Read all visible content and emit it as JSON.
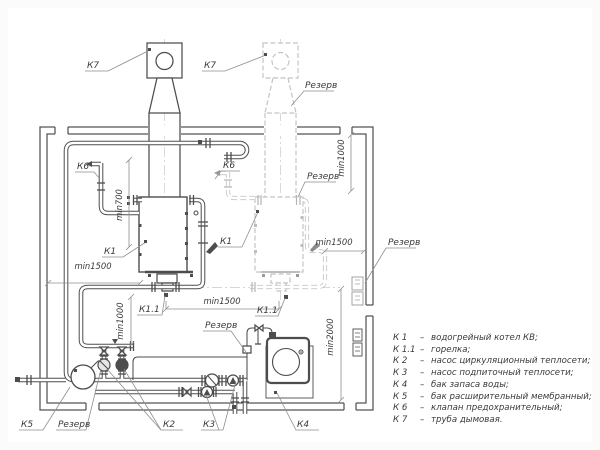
{
  "colors": {
    "line": "#4d4d4d",
    "reserve_line": "#c6c6c6",
    "background": "#ffffff",
    "text": "#3a3a3a"
  },
  "labels": {
    "k7_left": "К7",
    "k7_right": "К7",
    "k6_left": "К6",
    "k6_right": "К6",
    "k1_left": "К1",
    "k1_right": "К1",
    "k11_left": "К1.1",
    "k11_right": "К1.1",
    "k5": "К5",
    "k2": "К2",
    "k3": "К3",
    "k4": "К4",
    "reserve_chimney": "Резерв",
    "reserve_top": "Резерв",
    "reserve_wall": "Резерв",
    "reserve_makeup": "Резерв",
    "reserve_pump": "Резерв"
  },
  "dims": {
    "min700": "min700",
    "min1000_top": "min1000",
    "min1000_bottom": "min1000",
    "min1500_left": "min1500",
    "min1500_center": "min1500",
    "min1500_right": "min1500",
    "min2000": "min2000"
  },
  "legend": {
    "sep": "–",
    "items": [
      {
        "key": "К 1",
        "desc": "водогрейный котел КВ;"
      },
      {
        "key": "К 1.1",
        "desc": "горелка;"
      },
      {
        "key": "К 2",
        "desc": "насос циркуляционный теплосети;"
      },
      {
        "key": "К 3",
        "desc": "насос подпиточный теплосети;"
      },
      {
        "key": "К 4",
        "desc": "бак запаса воды;"
      },
      {
        "key": "К 5",
        "desc": "бак расширительный мембранный;"
      },
      {
        "key": "К 6",
        "desc": "клапан предохранительный;"
      },
      {
        "key": "К 7",
        "desc": "труба дымовая."
      }
    ]
  }
}
